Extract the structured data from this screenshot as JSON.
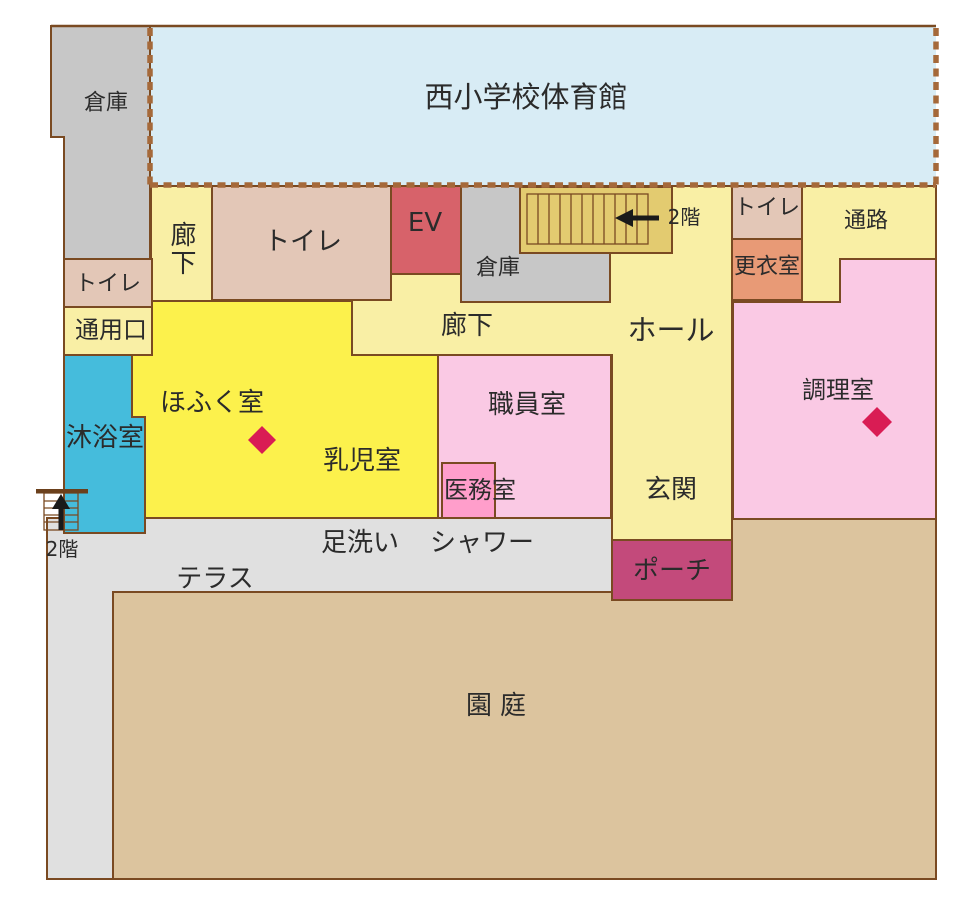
{
  "figure": {
    "type": "floor-plan",
    "floor": "1F"
  },
  "labels": {
    "gym": "西小学校体育館",
    "storage_top": "倉庫",
    "corridor_top": "廊下",
    "toilet_top": "トイレ",
    "ev": "EV",
    "storage_mid": "倉庫",
    "stairs_top_note": "2階",
    "toilet_right": "トイレ",
    "passage": "通路",
    "changing_room": "更衣室",
    "toilet_left": "トイレ",
    "service_entrance": "通用口",
    "bathing_room": "沐浴室",
    "crawling_room": "ほふく室",
    "infant_room": "乳児室",
    "corridor_main": "廊下",
    "hall": "ホール",
    "staff_room": "職員室",
    "medical_room": "医務室",
    "entrance": "玄関",
    "kitchen": "調理室",
    "porch": "ポーチ",
    "foot_wash": "足洗い",
    "shower": "シャワー",
    "terrace": "テラス",
    "stairs_bottom_note": "2階",
    "garden": "園庭"
  },
  "colors": {
    "outline": "#7a4a22",
    "dashed_border": "#a5693a",
    "gym": "#d8ecf5",
    "gray_room": "#c7c7c7",
    "light_yellow": "#f9efa5",
    "tan": "#e3c7b7",
    "ev_red": "#d7626a",
    "stairs_gold": "#e3cb70",
    "salmon": "#e89a76",
    "pink": "#fac9e4",
    "deep_pink": "#ff9ecb",
    "cyan": "#45bcdc",
    "bright_yellow": "#fcf14c",
    "porch_magenta": "#c34a7b",
    "terrace_gray": "#e0e0e0",
    "garden_tan": "#dcc49e",
    "diamond": "#d91c54",
    "text": "#2b2b2b"
  }
}
